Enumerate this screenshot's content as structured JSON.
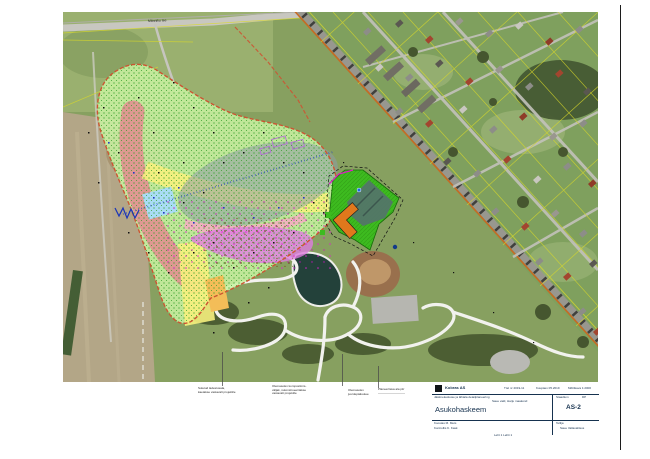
{
  "map": {
    "street_label": "Männiku tee",
    "colors": {
      "overlay_lime": "#c9f2a2",
      "stipple_green": "#2f9e27",
      "zone_red": "#e19090",
      "zone_yellow": "#f6ef7d",
      "zone_orange": "#f3bd58",
      "zone_gray": "rgba(142,156,166,0.55)",
      "zone_pink": "#f3aec0",
      "zone_violet": "#df7ce0",
      "zone_lightblue": "#a9dcf4",
      "boundary_dashed": "#cc5533",
      "site_green": "#3dbb1f",
      "building_orange": "#e0781c",
      "existing_teal": "#54736a",
      "pond": "#23413a",
      "cadastral_yellow": "#d9d92a"
    }
  },
  "annotations": [
    {
      "l1": "Suletud ladestusala,",
      "l2": "kaetakse vastavalt projektile",
      "l3": ""
    },
    {
      "l1": "Olemasolev kompostimis-",
      "l2": "väljak, rekonstrueeritakse",
      "l3": "vastavalt projektile"
    },
    {
      "l1": "Olemasolev",
      "l2": "juurdepääsutee",
      "l3": ""
    },
    {
      "l1": "Planeeritava ala piir",
      "l2": "—————————",
      "l3": ""
    }
  ],
  "title_block": {
    "company": "Kobras AS",
    "meta1": "Töö nr 2019-11",
    "meta2": "Kuupäev 05.2019",
    "meta3": "Mõõtkava 1:2000",
    "project_line1": "Jäätmekeskuse ja lähiala detailplaneering",
    "project_line2": "Saue vald, Harju maakond",
    "title": "Asukohaskeem",
    "stage_label": "Staadium",
    "stage": "DP",
    "sheet_no": "AS-2",
    "client_label": "Tellija",
    "client": "Saue Vallavalitsus",
    "author_line1": "Koostas   M. Mets",
    "author_line2": "Kontrollis   K. Kask",
    "note": "Leht 1   Lehti 1"
  }
}
